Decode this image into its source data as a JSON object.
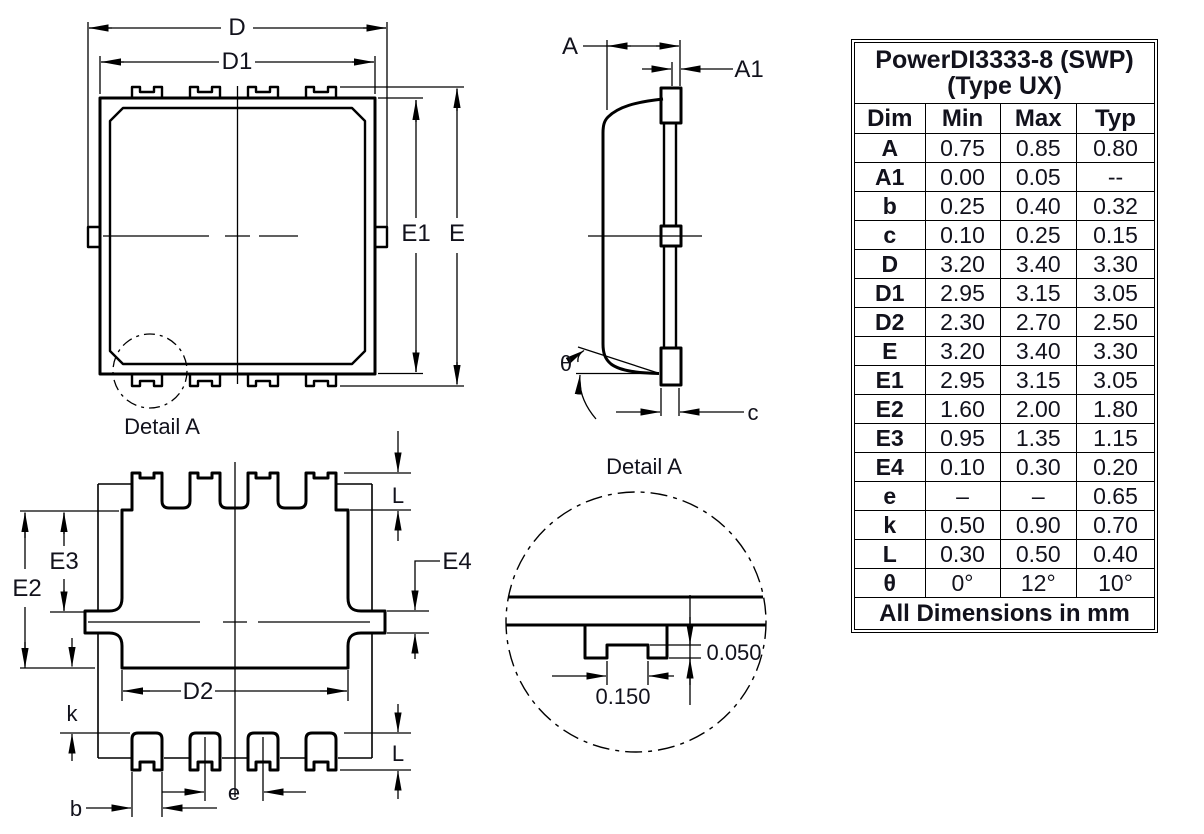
{
  "colors": {
    "line": "#000000",
    "text": "#12121c",
    "background": "#ffffff"
  },
  "views": {
    "top_view": {
      "dims": {
        "d": "D",
        "d1": "D1",
        "e1": "E1",
        "e": "E"
      },
      "detail_label": "Detail A"
    },
    "side_view": {
      "dims": {
        "a": "A",
        "a1": "A1",
        "theta": "θ",
        "c": "c"
      }
    },
    "bottom_view": {
      "dims": {
        "e2": "E2",
        "e3": "E3",
        "e4": "E4",
        "d2": "D2",
        "k": "k",
        "l_top": "L",
        "l_bottom": "L",
        "e_pitch": "e",
        "b": "b"
      }
    },
    "detail_view": {
      "title": "Detail A",
      "depth": "0.050",
      "width": "0.150"
    }
  },
  "table": {
    "title_line1": "PowerDI3333-8 (SWP)",
    "title_line2": "(Type UX)",
    "columns": [
      "Dim",
      "Min",
      "Max",
      "Typ"
    ],
    "rows": [
      [
        "A",
        "0.75",
        "0.85",
        "0.80"
      ],
      [
        "A1",
        "0.00",
        "0.05",
        "--"
      ],
      [
        "b",
        "0.25",
        "0.40",
        "0.32"
      ],
      [
        "c",
        "0.10",
        "0.25",
        "0.15"
      ],
      [
        "D",
        "3.20",
        "3.40",
        "3.30"
      ],
      [
        "D1",
        "2.95",
        "3.15",
        "3.05"
      ],
      [
        "D2",
        "2.30",
        "2.70",
        "2.50"
      ],
      [
        "E",
        "3.20",
        "3.40",
        "3.30"
      ],
      [
        "E1",
        "2.95",
        "3.15",
        "3.05"
      ],
      [
        "E2",
        "1.60",
        "2.00",
        "1.80"
      ],
      [
        "E3",
        "0.95",
        "1.35",
        "1.15"
      ],
      [
        "E4",
        "0.10",
        "0.30",
        "0.20"
      ],
      [
        "e",
        "–",
        "–",
        "0.65"
      ],
      [
        "k",
        "0.50",
        "0.90",
        "0.70"
      ],
      [
        "L",
        "0.30",
        "0.50",
        "0.40"
      ],
      [
        "θ",
        "0°",
        "12°",
        "10°"
      ]
    ],
    "footer": "All Dimensions in mm"
  }
}
